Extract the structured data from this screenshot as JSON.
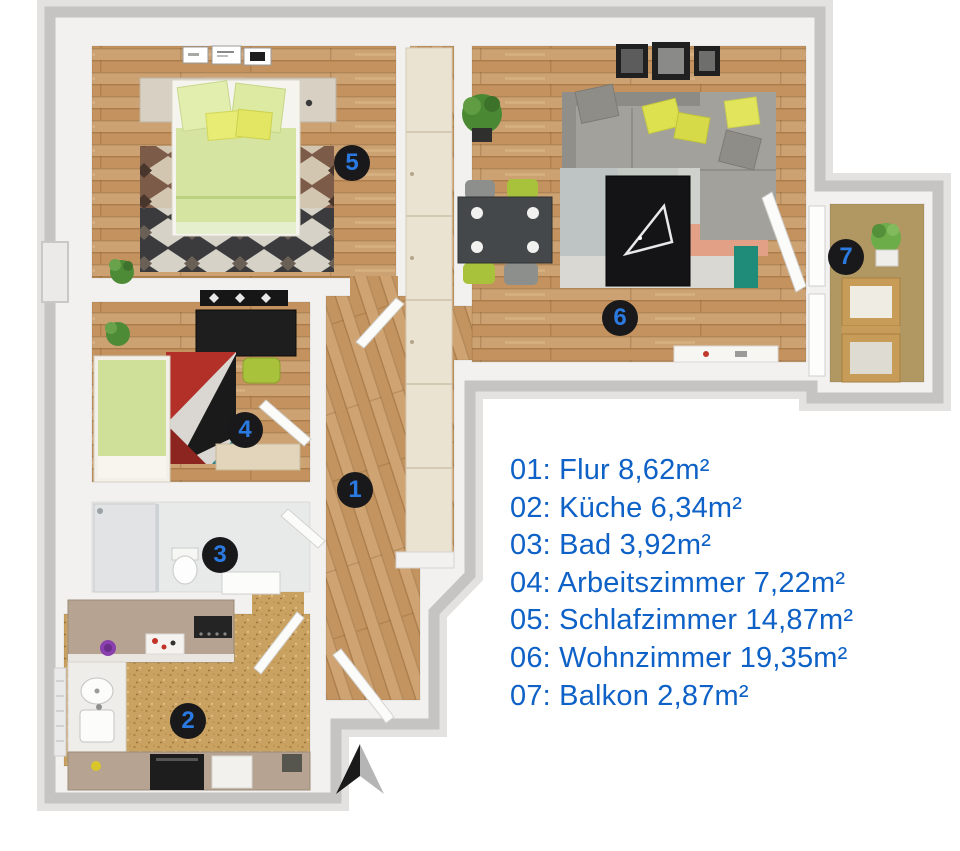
{
  "legend": {
    "items": [
      {
        "number": "01",
        "name": "Flur",
        "area": "8,62m²",
        "label": "01: Flur 8,62m²"
      },
      {
        "number": "02",
        "name": "Küche",
        "area": "6,34m²",
        "label": "02: Küche 6,34m²"
      },
      {
        "number": "03",
        "name": "Bad",
        "area": "3,92m²",
        "label": "03: Bad 3,92m²"
      },
      {
        "number": "04",
        "name": "Arbeitszimmer",
        "area": "7,22m²",
        "label": "04: Arbeitszimmer 7,22m²"
      },
      {
        "number": "05",
        "name": "Schlafzimmer",
        "area": "14,87m²",
        "label": "05: Schlafzimmer 14,87m²"
      },
      {
        "number": "06",
        "name": "Wohnzimmer",
        "area": "19,35m²",
        "label": "06: Wohnzimmer 19,35m²"
      },
      {
        "number": "07",
        "name": "Balkon",
        "area": "2,87m²",
        "label": "07: Balkon 2,87m²"
      }
    ]
  },
  "markers": [
    {
      "number": "1",
      "room": "Flur",
      "x": 355,
      "y": 490
    },
    {
      "number": "2",
      "room": "Küche",
      "x": 188,
      "y": 721
    },
    {
      "number": "3",
      "room": "Bad",
      "x": 220,
      "y": 555
    },
    {
      "number": "4",
      "room": "Arbeitszimmer",
      "x": 245,
      "y": 430
    },
    {
      "number": "5",
      "room": "Schlafzimmer",
      "x": 352,
      "y": 163
    },
    {
      "number": "6",
      "room": "Wohnzimmer",
      "x": 620,
      "y": 318
    },
    {
      "number": "7",
      "room": "Balkon",
      "x": 846,
      "y": 257
    }
  ],
  "colors": {
    "legend_text": "#0e61c6",
    "marker_background": "#19191b",
    "marker_number": "#2b7ae2"
  },
  "compass": {
    "direction": "north"
  }
}
